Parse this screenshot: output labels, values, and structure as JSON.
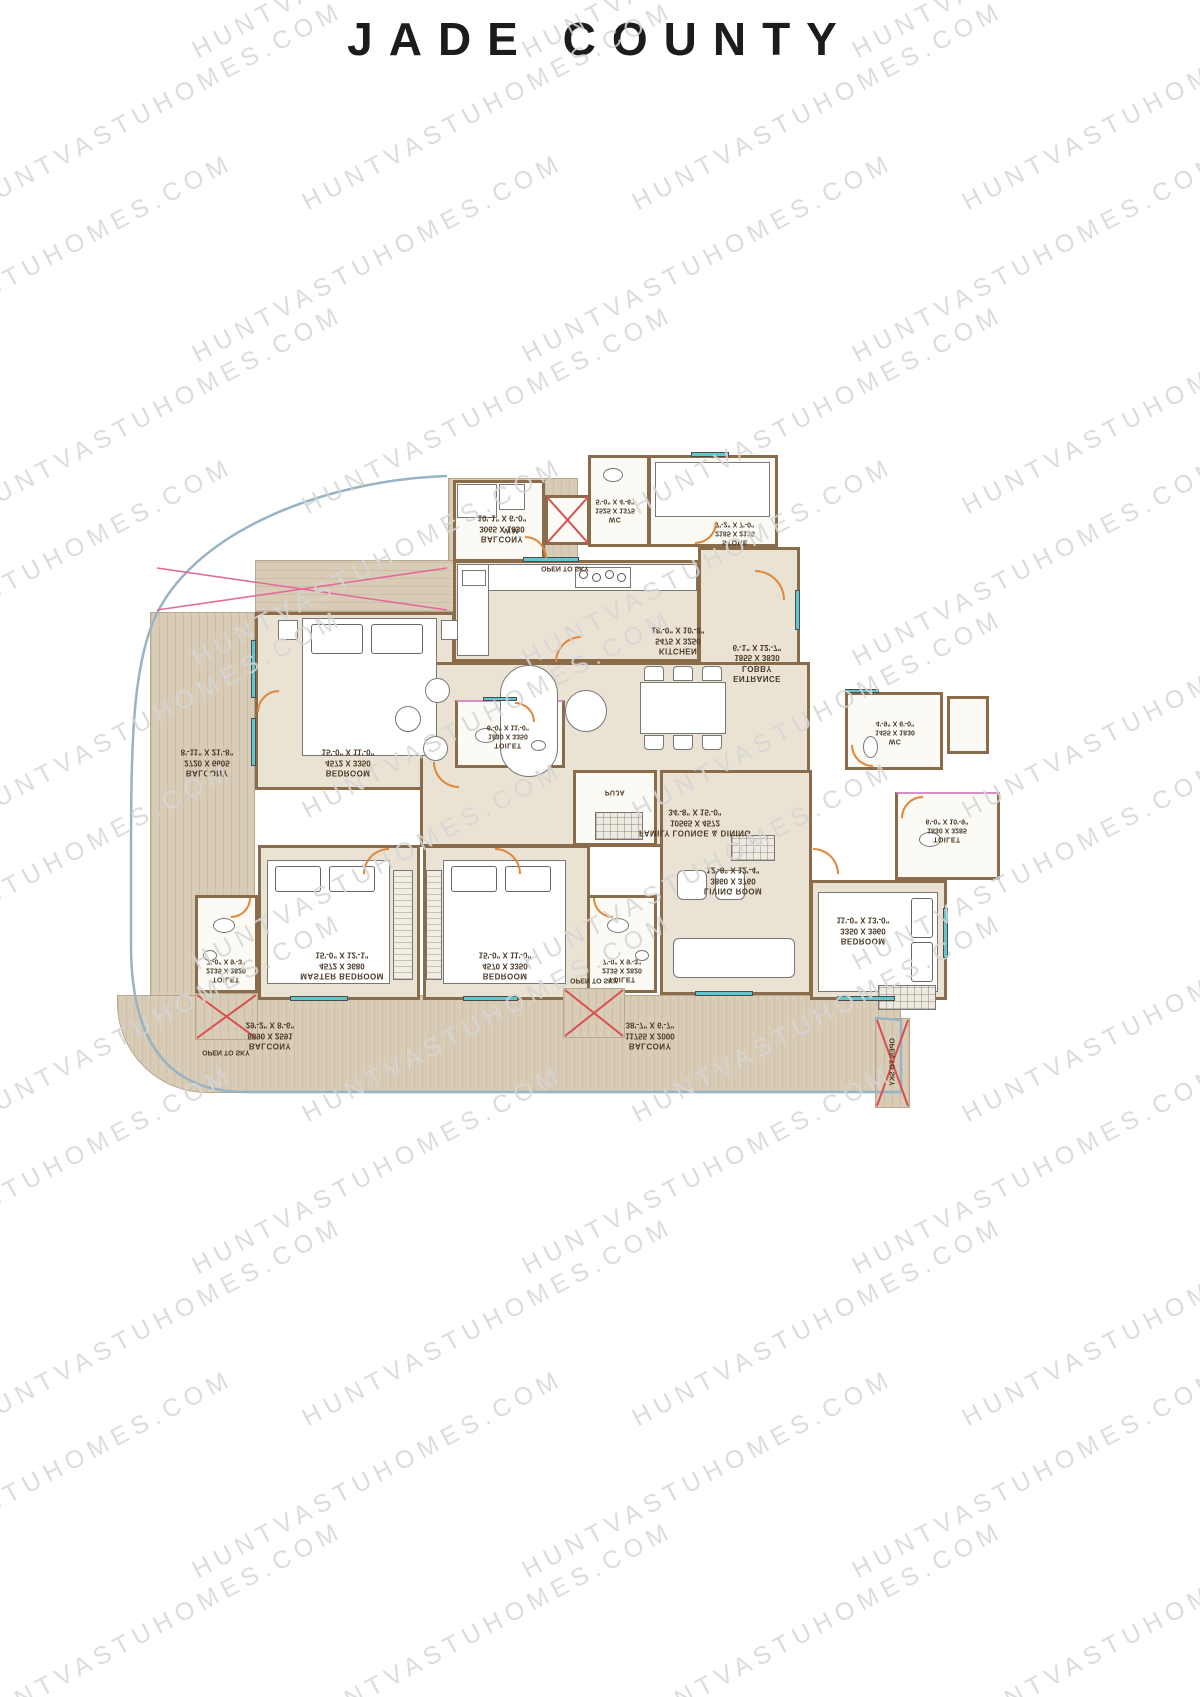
{
  "title": "JADE COUNTY",
  "watermark": {
    "text": "HUNTVASTUHOMES.COM",
    "color": "#d6d6d6"
  },
  "colors": {
    "wall": "#8a6c4a",
    "room_floor": "#eae3d3",
    "wet_floor": "#fbfaf5",
    "deck": "#d9ccb7",
    "door": "#e0873a",
    "window": "#5fc8ce",
    "open_to_sky_cross": "#d95050",
    "toilet_partition": "#d98ec9",
    "plot_boundary": "#97b3c4",
    "label_text": "#4a3a26",
    "title_text": "#1c1c1c"
  },
  "rooms": [
    {
      "id": "balcony_top",
      "name": "BALCONY",
      "mm": "3065 X 1830",
      "ft": "10'-1\" X 6'-0\""
    },
    {
      "id": "wc_top",
      "name": "WC",
      "mm": "1525 X 1375",
      "ft": "5'-0\" X 4'-6\""
    },
    {
      "id": "store",
      "name": "STORE",
      "mm": "2185 X 2135",
      "ft": "7'-2\" X 7'-0\""
    },
    {
      "id": "kitchen",
      "name": "KITCHEN",
      "mm": "5475 X 3250",
      "ft": "18'-0\" X 10'-8\""
    },
    {
      "id": "entrance_lobby",
      "name": "ENTRANCE LOBBY",
      "mm": "1855 X 3830",
      "ft": "6'-1\" X 12'-7\""
    },
    {
      "id": "bedroom_top",
      "name": "BEDROOM",
      "mm": "4572 X 3350",
      "ft": "15'-0\" X 11'-0\""
    },
    {
      "id": "toilet_top",
      "name": "TOILET",
      "mm": "1830 X 3350",
      "ft": "6'-0\" X 11'-0\""
    },
    {
      "id": "family",
      "name": "FAMILY LOUNGE & DINING",
      "mm": "10565 X 4572",
      "ft": "34'-8\" X 15'-0\""
    },
    {
      "id": "balcony_left",
      "name": "BALCONY",
      "mm": "2720 X 6605",
      "ft": "8'-11\" X 21'-8\""
    },
    {
      "id": "living",
      "name": "LIVING ROOM",
      "mm": "3860 X 3760",
      "ft": "12'-8\" X 12'-4\""
    },
    {
      "id": "wc_right",
      "name": "WC",
      "mm": "1455 X 1830",
      "ft": "4'-9\" X 6'-0\""
    },
    {
      "id": "toilet_right",
      "name": "TOILET",
      "mm": "1830 X 3285",
      "ft": "6'-0\" X 10'-9\""
    },
    {
      "id": "bedroom_right",
      "name": "BEDROOM",
      "mm": "3350 X 3960",
      "ft": "11'-0\" X 13'-0\""
    },
    {
      "id": "puja",
      "name": "PUJA",
      "mm": "",
      "ft": ""
    },
    {
      "id": "toilet_master",
      "name": "TOILET",
      "mm": "2135 X 2820",
      "ft": "7'-0\" X 9'-3\""
    },
    {
      "id": "master_bedroom",
      "name": "MASTER BEDROOM",
      "mm": "4572 X 3680",
      "ft": "15'-0\" X 12'-1\""
    },
    {
      "id": "bedroom_mid",
      "name": "BEDROOM",
      "mm": "4570 X 3350",
      "ft": "15'-0\" X 11'-0\""
    },
    {
      "id": "toilet_mid",
      "name": "TOILET",
      "mm": "2135 X 2820",
      "ft": "7'-0\" X 9'-3\""
    },
    {
      "id": "balcony_bottom_left",
      "name": "BALCONY",
      "mm": "8890 X 2591",
      "ft": "29'-2\" X 8'-6\""
    },
    {
      "id": "balcony_bottom_right",
      "name": "BALCONY",
      "mm": "11755 X 2000",
      "ft": "38'-7\" X 6'-7\""
    }
  ],
  "annotations": {
    "open_to_sky": "OPEN TO SKY",
    "washing_machine": "W.M."
  }
}
